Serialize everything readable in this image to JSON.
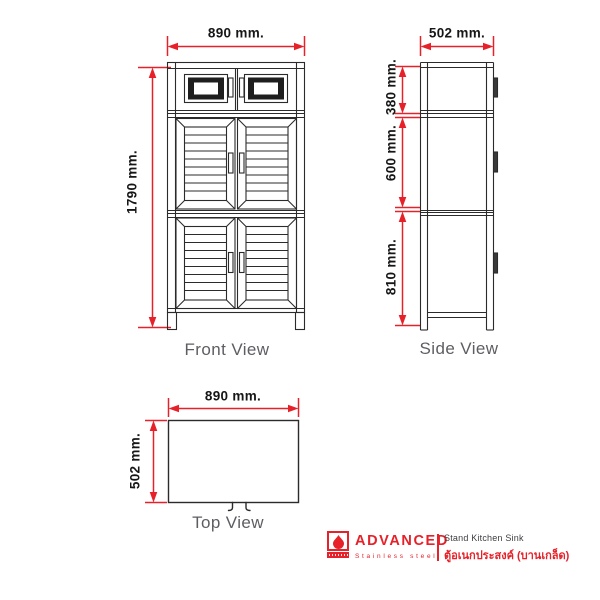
{
  "views": {
    "front": {
      "label": "Front View",
      "width_dim": "890 mm.",
      "height_dim": "1790 mm."
    },
    "side": {
      "label": "Side View",
      "width_dim": "502 mm.",
      "upper_dim": "380 mm.",
      "middle_dim": "600 mm.",
      "lower_dim": "810 mm."
    },
    "top": {
      "label": "Top View",
      "width_dim": "890 mm.",
      "depth_dim": "502 mm."
    }
  },
  "footer": {
    "brand": "ADVANCED",
    "tagline": "Stainless steel",
    "product_en": "Stand Kitchen Sink",
    "product_th": "ตู้อเนกประสงค์ (บานเกล็ด)"
  },
  "colors": {
    "dimension_red": "#e62129",
    "drawing_line": "#2b2b2b",
    "caption_gray": "#5d5e63"
  }
}
